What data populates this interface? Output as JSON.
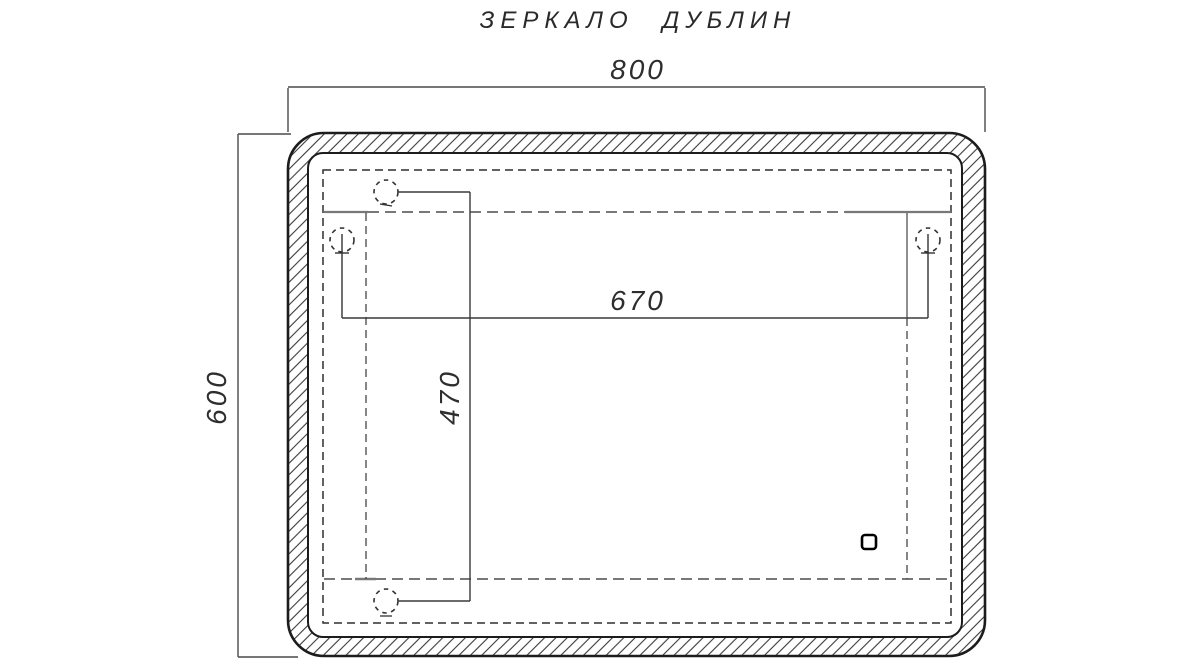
{
  "title": "ЗЕРКАЛО ДУБЛИН",
  "drawing": {
    "type": "technical-drawing",
    "object": "mirror front view",
    "dimensions": {
      "overall_width_label": "800",
      "overall_height_label": "600",
      "hook_span_horizontal_label": "670",
      "hook_span_vertical_label": "470"
    },
    "symbols": {
      "mounting_hook_icon": "dashed-circle-with-arrow",
      "touch_sensor_icon": "rounded-square-outline",
      "frame_section": "diagonal-hatch-band",
      "hidden_edges": "dashed-lines"
    },
    "colors": {
      "outline": "#1c1c1c",
      "dimension_lines": "#4a4a4a",
      "hidden_lines": "#787878",
      "hatch": "#3a3a3a",
      "background": "#ffffff"
    }
  }
}
